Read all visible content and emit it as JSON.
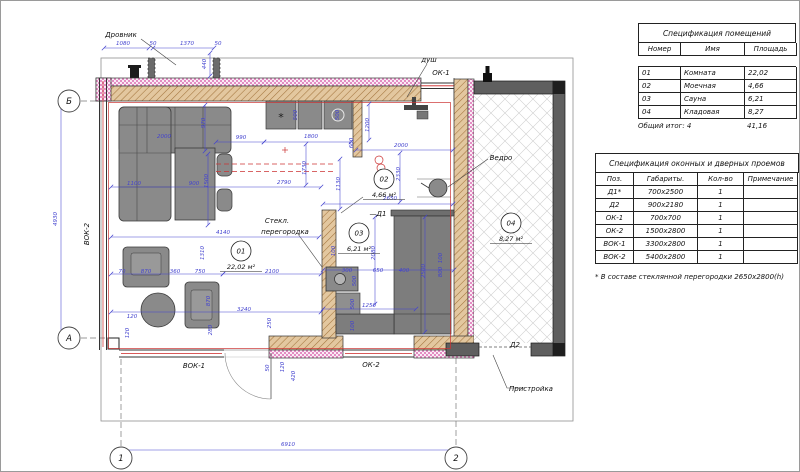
{
  "colors": {
    "dimension_blue": "#4343cf",
    "wall_fill_tan": "#e3c79f",
    "hatch_brown": "#a3743d",
    "insulation_pink": "#d965ae",
    "marker_red": "#cc3333",
    "furniture_gray": "#8a8a8a",
    "annex_wall_gray": "#5f5f5f"
  },
  "schedule_rooms": {
    "title": "Спецификация помещений",
    "headers": [
      "Номер",
      "Имя",
      "Площадь"
    ],
    "rows": [
      [
        "01",
        "Комната",
        "22,02"
      ],
      [
        "02",
        "Моечная",
        "4,66"
      ],
      [
        "03",
        "Сауна",
        "6,21"
      ],
      [
        "04",
        "Кладовая",
        "8,27"
      ]
    ],
    "total_label": "Общий итог: 4",
    "total_value": "41,16"
  },
  "schedule_openings": {
    "title": "Спецификация оконных и дверных проемов",
    "headers": [
      "Поз.",
      "Габариты.",
      "Кол-во",
      "Примечание"
    ],
    "rows": [
      [
        "Д1*",
        "700x2500",
        "1",
        ""
      ],
      [
        "Д2",
        "900x2180",
        "1",
        ""
      ],
      [
        "ОК-1",
        "700x700",
        "1",
        ""
      ],
      [
        "ОК-2",
        "1500x2800",
        "1",
        ""
      ],
      [
        "ВОК-1",
        "3300x2800",
        "1",
        ""
      ],
      [
        "ВОК-2",
        "5400x2800",
        "1",
        ""
      ]
    ],
    "footnote": "* В составе стеклянной перегородки 2650x2800(h)"
  },
  "plan": {
    "axes": [
      {
        "t": "Б",
        "x": 68,
        "y": 100
      },
      {
        "t": "А",
        "x": 68,
        "y": 337
      },
      {
        "t": "1",
        "x": 120,
        "y": 457
      },
      {
        "t": "2",
        "x": 455,
        "y": 457
      }
    ],
    "rooms": [
      {
        "num": "01",
        "area": "22,02 м²",
        "x": 240,
        "y": 250
      },
      {
        "num": "02",
        "area": "4,66 м²",
        "x": 383,
        "y": 178
      },
      {
        "num": "03",
        "area": "6,21 м²",
        "x": 358,
        "y": 232
      },
      {
        "num": "04",
        "area": "8,27 м²",
        "x": 510,
        "y": 222
      }
    ],
    "labels": [
      {
        "t": "Дровник",
        "x": 120,
        "y": 36
      },
      {
        "t": "душ",
        "x": 428,
        "y": 61
      },
      {
        "t": "ОК-1",
        "x": 440,
        "y": 74
      },
      {
        "t": "Ведро",
        "x": 500,
        "y": 159
      },
      {
        "t": "Стекл.",
        "x": 276,
        "y": 222
      },
      {
        "t": "перегородка",
        "x": 284,
        "y": 233
      },
      {
        "t": "—Д1",
        "x": 377,
        "y": 215
      },
      {
        "t": "ВОК-1",
        "x": 193,
        "y": 367
      },
      {
        "t": "ОК-2",
        "x": 370,
        "y": 366
      },
      {
        "t": "Д2",
        "x": 514,
        "y": 346
      },
      {
        "t": "Пристройка",
        "x": 530,
        "y": 390
      },
      {
        "t": "ВОК-2",
        "x": 88,
        "y": 233,
        "r": -90
      }
    ],
    "dims": [
      {
        "t": "1080",
        "x": 122,
        "y": 44,
        "l": [
          103,
          47,
          148,
          47
        ]
      },
      {
        "t": "50",
        "x": 152,
        "y": 44
      },
      {
        "t": "1370",
        "x": 186,
        "y": 44,
        "l": [
          152,
          47,
          213,
          47
        ]
      },
      {
        "t": "50",
        "x": 217,
        "y": 44
      },
      {
        "t": "440",
        "x": 205,
        "y": 63,
        "r": -90,
        "l": [
          209,
          52,
          209,
          75
        ]
      },
      {
        "t": "4930",
        "x": 56,
        "y": 218,
        "r": -90,
        "l": [
          60,
          102,
          60,
          335
        ]
      },
      {
        "t": "6910",
        "x": 287,
        "y": 445,
        "l": [
          120,
          449,
          455,
          449
        ]
      },
      {
        "t": "990",
        "x": 240,
        "y": 138,
        "l": [
          215,
          141,
          263,
          141
        ]
      },
      {
        "t": "1800",
        "x": 310,
        "y": 137,
        "l": [
          263,
          141,
          350,
          141
        ]
      },
      {
        "t": "600",
        "x": 352,
        "y": 142,
        "r": -90
      },
      {
        "t": "1200",
        "x": 368,
        "y": 124,
        "r": -90,
        "l": [
          368,
          103,
          368,
          139
        ]
      },
      {
        "t": "2000",
        "x": 400,
        "y": 146,
        "l": [
          355,
          149,
          452,
          149
        ]
      },
      {
        "t": "2330",
        "x": 399,
        "y": 173,
        "r": -90,
        "l": [
          399,
          152,
          399,
          201
        ]
      },
      {
        "t": "500",
        "x": 296,
        "y": 114,
        "r": -90
      },
      {
        "t": "500",
        "x": 338,
        "y": 114,
        "r": -90
      },
      {
        "t": "2000",
        "x": 163,
        "y": 137
      },
      {
        "t": "970",
        "x": 204,
        "y": 122,
        "r": -90,
        "l": [
          204,
          104,
          204,
          150
        ]
      },
      {
        "t": "1100",
        "x": 133,
        "y": 184
      },
      {
        "t": "900",
        "x": 193,
        "y": 184
      },
      {
        "t": "1500",
        "x": 207,
        "y": 180,
        "r": -90,
        "l": [
          207,
          153,
          207,
          224
        ]
      },
      {
        "t": "2790",
        "x": 283,
        "y": 183,
        "l": [
          110,
          186,
          320,
          186
        ]
      },
      {
        "t": "1730",
        "x": 305,
        "y": 167,
        "r": -90,
        "l": [
          305,
          143,
          305,
          184
        ]
      },
      {
        "t": "1130",
        "x": 339,
        "y": 183,
        "r": -90,
        "l": [
          339,
          158,
          339,
          208
        ]
      },
      {
        "t": "2650",
        "x": 389,
        "y": 199,
        "l": [
          322,
          203,
          452,
          203
        ]
      },
      {
        "t": "4140",
        "x": 222,
        "y": 233,
        "l": [
          110,
          236,
          318,
          236
        ]
      },
      {
        "t": "2080",
        "x": 374,
        "y": 252,
        "r": -90,
        "l": [
          374,
          216,
          374,
          303
        ]
      },
      {
        "t": "1310",
        "x": 203,
        "y": 252,
        "r": -90
      },
      {
        "t": "70",
        "x": 121,
        "y": 272
      },
      {
        "t": "870",
        "x": 145,
        "y": 272,
        "l": [
          110,
          273,
          222,
          273
        ]
      },
      {
        "t": "360",
        "x": 174,
        "y": 272
      },
      {
        "t": "750",
        "x": 199,
        "y": 272
      },
      {
        "t": "2100",
        "x": 271,
        "y": 272,
        "l": [
          222,
          273,
          320,
          273
        ]
      },
      {
        "t": "3240",
        "x": 243,
        "y": 310,
        "l": [
          110,
          311,
          320,
          311
        ]
      },
      {
        "t": "120",
        "x": 131,
        "y": 317
      },
      {
        "t": "120",
        "x": 128,
        "y": 332,
        "r": -90
      },
      {
        "t": "280",
        "x": 211,
        "y": 329,
        "r": -90
      },
      {
        "t": "870",
        "x": 209,
        "y": 300,
        "r": -90
      },
      {
        "t": "250",
        "x": 270,
        "y": 322,
        "r": -90
      },
      {
        "t": "100",
        "x": 334,
        "y": 250,
        "r": -90
      },
      {
        "t": "300",
        "x": 346,
        "y": 271
      },
      {
        "t": "500",
        "x": 355,
        "y": 280,
        "r": -90
      },
      {
        "t": "650",
        "x": 377,
        "y": 271,
        "l": [
          322,
          269,
          453,
          269
        ]
      },
      {
        "t": "400",
        "x": 403,
        "y": 271
      },
      {
        "t": "2500",
        "x": 424,
        "y": 270,
        "r": -90,
        "l": [
          424,
          216,
          424,
          331
        ]
      },
      {
        "t": "800",
        "x": 441,
        "y": 271,
        "r": -90
      },
      {
        "t": "100",
        "x": 441,
        "y": 257,
        "r": -90
      },
      {
        "t": "1250",
        "x": 368,
        "y": 306,
        "l": [
          322,
          308,
          415,
          308
        ]
      },
      {
        "t": "500",
        "x": 353,
        "y": 303,
        "r": -90
      },
      {
        "t": "100",
        "x": 353,
        "y": 325,
        "r": -90
      },
      {
        "t": "50",
        "x": 268,
        "y": 367,
        "r": -90
      },
      {
        "t": "120",
        "x": 283,
        "y": 366,
        "r": -90
      },
      {
        "t": "420",
        "x": 294,
        "y": 375,
        "r": -90
      }
    ]
  }
}
